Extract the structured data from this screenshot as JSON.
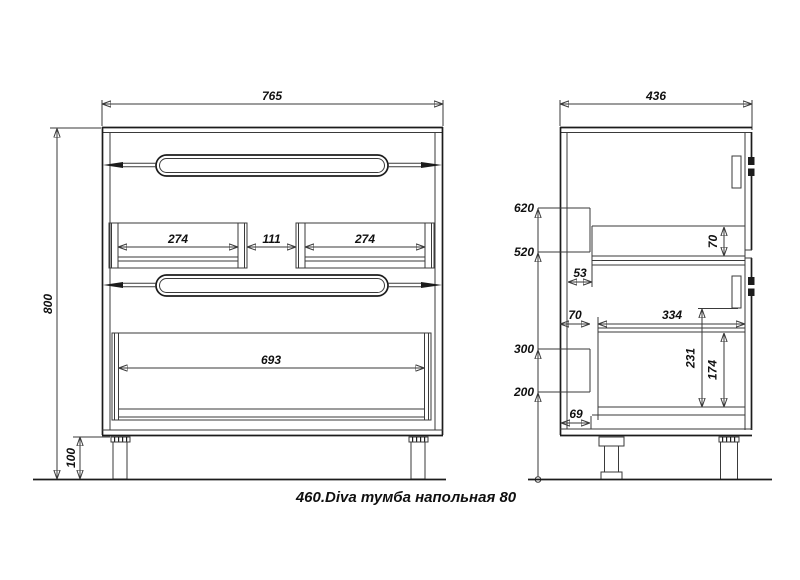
{
  "caption": "460.Diva тумба напольная 80",
  "front_view": {
    "overall_width": "765",
    "overall_height": "800",
    "leg_height": "100",
    "left_drawer_inner_width": "274",
    "center_gap_width": "111",
    "right_drawer_inner_width": "274",
    "bottom_drawer_inner_width": "693"
  },
  "side_view": {
    "overall_depth": "436",
    "upper_rail_top_height": "620",
    "upper_rail_bottom_height": "520",
    "lower_rail_top_height": "300",
    "lower_rail_bottom_height": "200",
    "upper_drawer_back_gap": "53",
    "upper_drawer_side_height": "70",
    "lower_drawer_back_gap": "70",
    "lower_drawer_inner_depth": "334",
    "lower_compartment_height": "231",
    "lower_drawer_side_height": "174",
    "bottom_back_gap": "69"
  },
  "colors": {
    "line": "#3a3a3a",
    "outline": "#1c1c1c",
    "text": "#101010",
    "background": "#ffffff"
  }
}
